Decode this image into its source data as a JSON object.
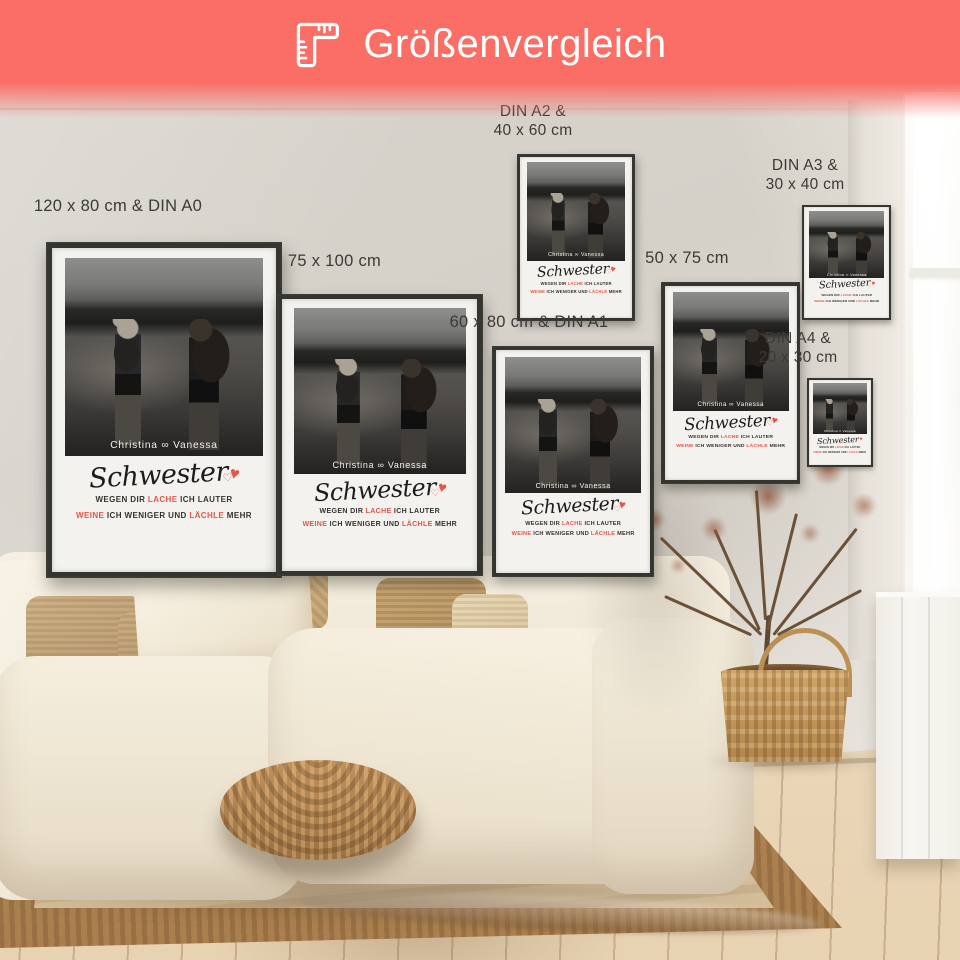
{
  "header": {
    "title": "Größenvergleich",
    "icon": "ruler-corner-icon",
    "bg_color": "#fb6e66"
  },
  "labels": [
    {
      "line1": "120 x 80 cm & DIN A0",
      "line2": ""
    },
    {
      "line1": "75 x 100 cm",
      "line2": ""
    },
    {
      "line1": "60 x 80 cm & DIN A1",
      "line2": ""
    },
    {
      "line1": "DIN A2 &",
      "line2": "40 x 60 cm"
    },
    {
      "line1": "50 x 75 cm",
      "line2": ""
    },
    {
      "line1": "DIN A3 &",
      "line2": "30 x 40 cm"
    },
    {
      "line1": "DIN A4 &",
      "line2": "20 x 30 cm"
    }
  ],
  "poster": {
    "names": "Christina ∞ Vanessa",
    "title": "Schwester",
    "heart_outline": "♡",
    "heart_filled": "♥",
    "caption1": {
      "pre": "WEGEN DIR",
      "accent": "LACHE",
      "post": "ICH LAUTER"
    },
    "caption2": {
      "accent1": "WEINE",
      "mid": "ICH WENIGER UND",
      "accent2": "LÄCHLE",
      "post": "MEHR"
    }
  },
  "colors": {
    "accent": "#e4564b",
    "header_bg": "#fb6e66",
    "frame": "#34352f",
    "label_text": "#3b3a37"
  }
}
